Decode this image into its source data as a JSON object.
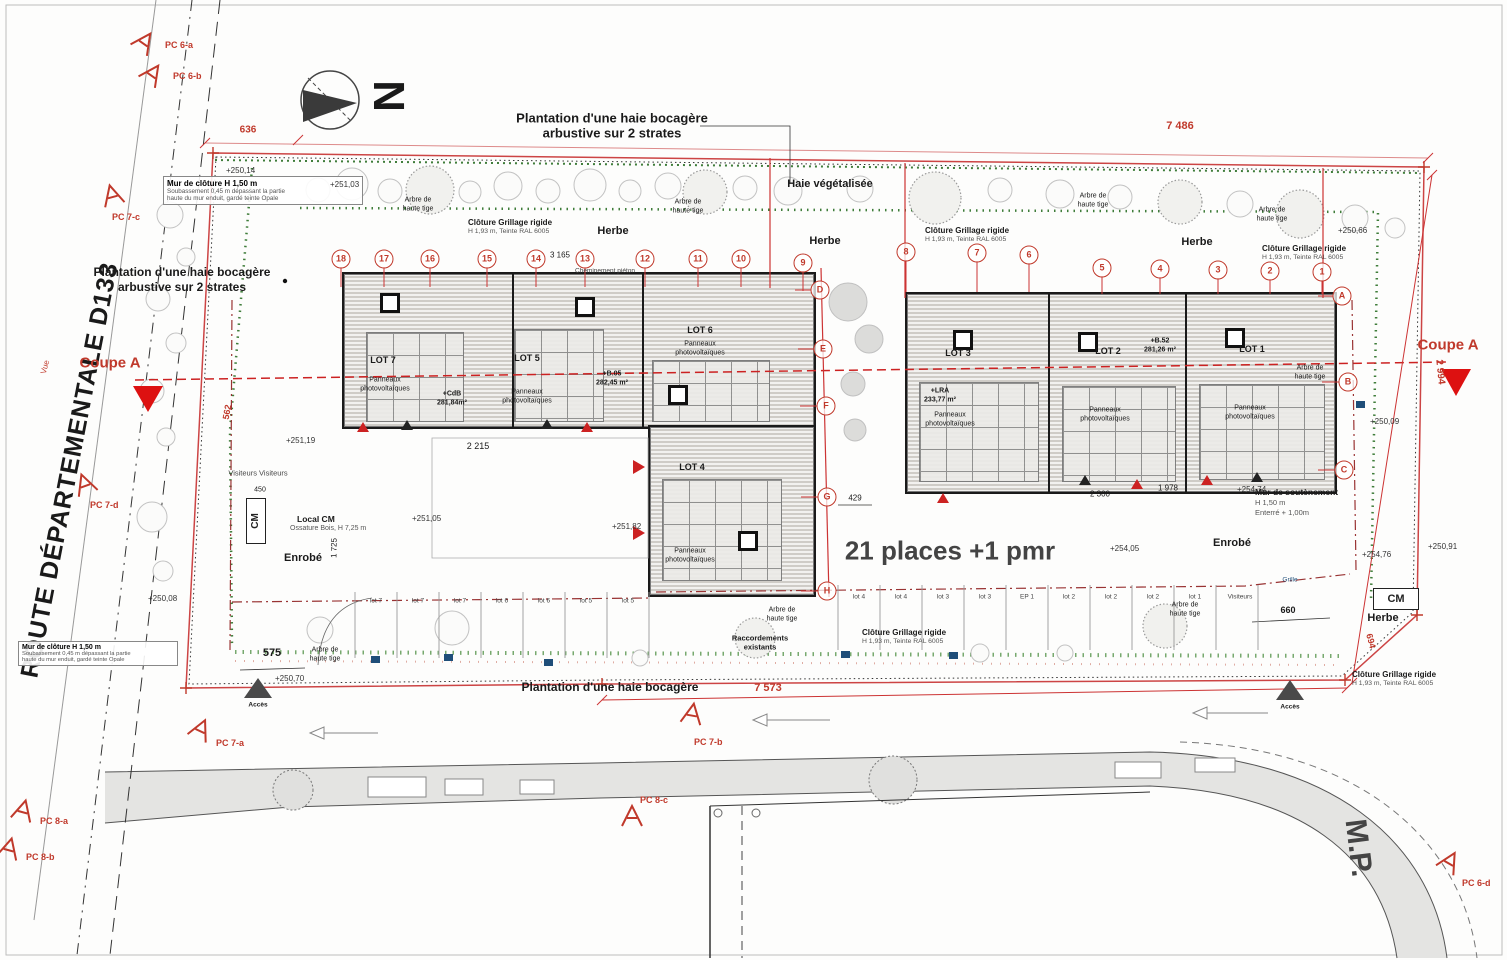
{
  "plan_meta": {
    "north_letter": "N",
    "route_name": "ROUTE DÉPARTEMENTALE D133",
    "mp_label": "M.P.",
    "coupe_label": "Coupe A",
    "vue_label": "Vue"
  },
  "notes": {
    "haie_top_1": "Plantation d'une haie bocagère",
    "haie_top_2": "arbustive sur 2 strates",
    "haie_bottom": "Plantation d'une haie bocagère",
    "haie_veg": "Haie végétalisée",
    "herbe": "Herbe",
    "enrobe": "Enrobé",
    "arbre_1": "Arbre de",
    "arbre_2": "haute tige",
    "cloture_1": "Clôture Grillage rigide",
    "cloture_2": "H 1,93 m, Teinte RAL 6005",
    "parking_note": "21 places +1 pmr",
    "cheminement": "Cheminement piéton",
    "raccord_1": "Raccordements",
    "raccord_2": "existants",
    "local_cm_1": "Local CM",
    "local_cm_2": "Ossature Bois, H 7,25 m",
    "cm": "CM",
    "visiteurs": "Visiteurs  Visiteurs",
    "mur_sout_1": "Mur de soutènement",
    "mur_sout_2": "H 1,50 m",
    "mur_sout_3": "Enterré + 1,00m",
    "mur_clot_titre": "Mur de clôture H 1,50 m",
    "mur_clot_l1": "Soubassement 0,45 m dépassant la partie",
    "mur_clot_l2": "haute du mur enduit, gardé teinte Opale",
    "acces": "Accès",
    "grille": "Grille"
  },
  "lots": {
    "lot1": "LOT 1",
    "lot2": "LOT 2",
    "lot3": "LOT 3",
    "lot4": "LOT 4",
    "lot5": "LOT 5",
    "lot6": "LOT 6",
    "lot7": "LOT 7",
    "pv_1": "Panneaux",
    "pv_2": "photovoltaïques",
    "area_cdb_1": "+CdB",
    "area_cdb_2": "281,84m²",
    "area_b05_1": "+B.05",
    "area_b05_2": "282,45 m²",
    "area_lra_1": "+LRA",
    "area_lra_2": "233,77 m²",
    "area_b52_1": "+B.52",
    "area_b52_2": "281,26 m²"
  },
  "dims": {
    "d636": "636",
    "d7486": "7 486",
    "d7573": "7 573",
    "d2994": "2 994",
    "d694": "694",
    "d562": "562",
    "d575": "575",
    "d2215": "2 215",
    "d2300": "2 300",
    "d1978": "1 978",
    "d3165": "3 165",
    "d429": "429",
    "d660": "660",
    "d1725": "1 725",
    "d450": "450"
  },
  "levels": {
    "l1": "+250,14",
    "l2": "+251,03",
    "l3": "+250,66",
    "l4": "+250,09",
    "l5": "+254,76",
    "l6": "+250,91",
    "l7": "+254,74",
    "l8": "+254,05",
    "l9": "+251,05",
    "l10": "+251,82",
    "l11": "+251,19",
    "l12": "+250,70",
    "l13": "+250,08"
  },
  "markers": {
    "pc6a": "PC 6-a",
    "pc6b": "PC 6-b",
    "pc6d": "PC 6-d",
    "pc7a": "PC 7-a",
    "pc7b": "PC 7-b",
    "pc7c": "PC 7-c",
    "pc7d": "PC 7-d",
    "pc8a": "PC 8-a",
    "pc8b": "PC 8-b",
    "pc8c": "PC 8-c"
  },
  "grid": {
    "numbers": [
      "18",
      "17",
      "16",
      "15",
      "14",
      "13",
      "12",
      "11",
      "10",
      "9",
      "8",
      "7",
      "6",
      "5",
      "4",
      "3",
      "2",
      "1"
    ],
    "letters": [
      "A",
      "B",
      "C",
      "D",
      "E",
      "F",
      "G",
      "H"
    ]
  },
  "parking": {
    "stalls_left": [
      "lot 7",
      "lot 7",
      "lot 7",
      "lot 6",
      "lot 6",
      "lot 5",
      "lot 5"
    ],
    "stalls_right": [
      "lot 4",
      "lot 4",
      "lot 3",
      "lot 3",
      "EP 1",
      "lot 2",
      "lot 2",
      "lot 2",
      "lot 1",
      "Visiteurs"
    ]
  }
}
